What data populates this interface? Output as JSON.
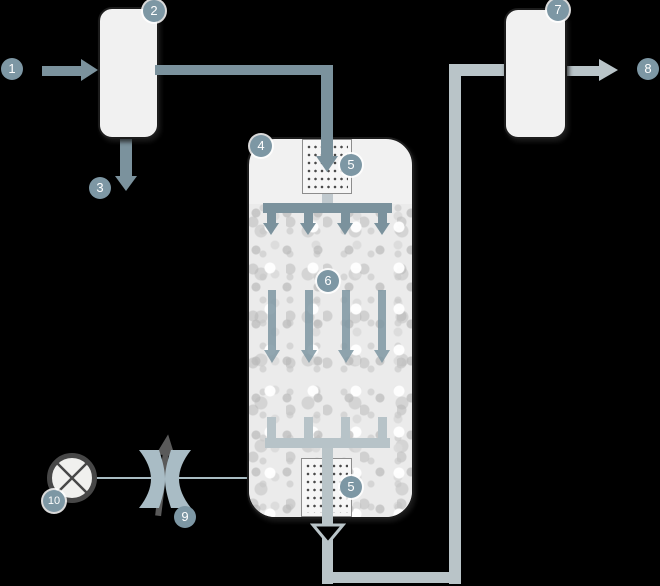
{
  "markers": [
    {
      "label": "1"
    },
    {
      "label": "2"
    },
    {
      "label": "3"
    },
    {
      "label": "4"
    },
    {
      "label": "5"
    },
    {
      "label": "6"
    },
    {
      "label": "5"
    },
    {
      "label": "7"
    },
    {
      "label": "8"
    },
    {
      "label": "9"
    },
    {
      "label": "10"
    }
  ],
  "icons": [
    "pump-icon",
    "mixing-valve-icon",
    "up-arrow-icon",
    "diffuser-plate-icon",
    "filter-media-texture",
    "flow-arrow-icon",
    "vessel-shape"
  ],
  "colors": {
    "background": "#000000",
    "pipe_dark": "#7b929d",
    "pipe_light": "#b9c4c8",
    "manifold_light": "#b7c3c8",
    "badge_fill": "#7d97a4",
    "badge_text": "#ffffff",
    "vessel_fill": "#f1f1f1",
    "media_fill": "#ebebeb",
    "vessel_outline": "#1c1c1c",
    "pump_ring": "#474747",
    "dark_arrow": "#5a5a5a",
    "thin_line": "#a9bcc3"
  }
}
